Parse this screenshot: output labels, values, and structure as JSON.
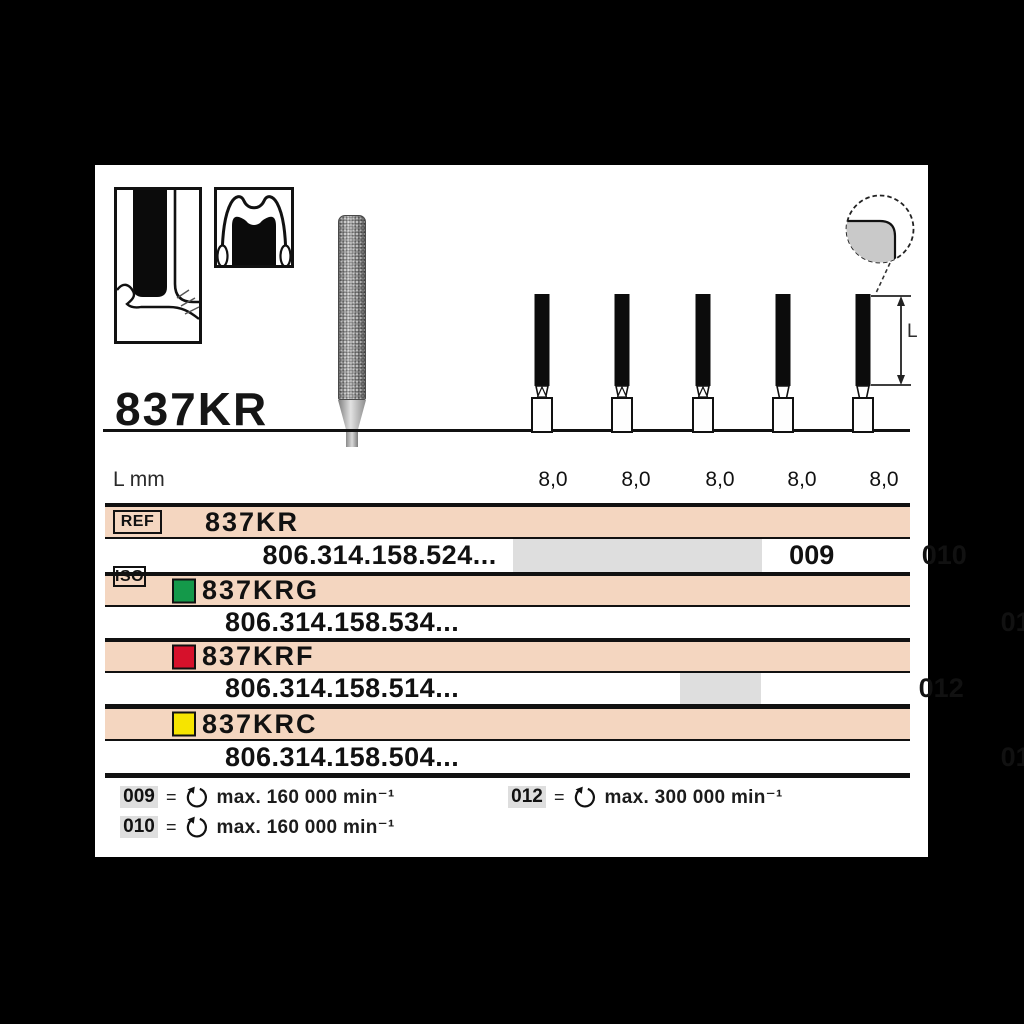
{
  "title": "837KR",
  "icons": {
    "detail_icon": "magnified-rounded-edge-circle",
    "rotation_icon": "counterclockwise-rotation-arrow",
    "diagram1": "bur-in-preparation-cross-section",
    "diagram2": "crown-preparation-tooth"
  },
  "dimension": {
    "label": "L"
  },
  "length_row": {
    "label": "L mm",
    "values": [
      "8,0",
      "8,0",
      "8,0",
      "8,0",
      "8,0"
    ]
  },
  "table": {
    "ref_badge": "REF",
    "iso_badge": "ISO",
    "groups": [
      {
        "name": "837KR",
        "swatch": null,
        "code": "806.314.158.524...",
        "sizes": [
          {
            "col": 1,
            "value": "009"
          },
          {
            "col": 2,
            "value": "010"
          },
          {
            "col": 3,
            "value": "012"
          },
          {
            "col": 4,
            "value": "014"
          }
        ],
        "shaded_cols": [
          1,
          2,
          3
        ]
      },
      {
        "name": "837KRG",
        "swatch": "#14994a",
        "code": "806.314.158.534...",
        "sizes": [
          {
            "col": 4,
            "value": "014"
          },
          {
            "col": 5,
            "value": "018"
          }
        ],
        "shaded_cols": []
      },
      {
        "name": "837KRF",
        "swatch": "#d6112b",
        "code": "806.314.158.514...",
        "sizes": [
          {
            "col": 3,
            "value": "012"
          }
        ],
        "shaded_cols": [
          3
        ]
      },
      {
        "name": "837KRC",
        "swatch": "#f6e400",
        "code": "806.314.158.504...",
        "sizes": [
          {
            "col": 4,
            "value": "014"
          }
        ],
        "shaded_cols": []
      }
    ]
  },
  "legend": [
    {
      "size": "009",
      "speed": "max. 160 000 min⁻¹"
    },
    {
      "size": "010",
      "speed": "max. 160 000 min⁻¹"
    },
    {
      "size": "012",
      "speed": "max. 300 000 min⁻¹"
    }
  ],
  "colors": {
    "row_highlight": "#f4d6c0",
    "cell_shade": "#dedede",
    "swatch_green": "#14994a",
    "swatch_red": "#d6112b",
    "swatch_yellow": "#f6e400"
  }
}
